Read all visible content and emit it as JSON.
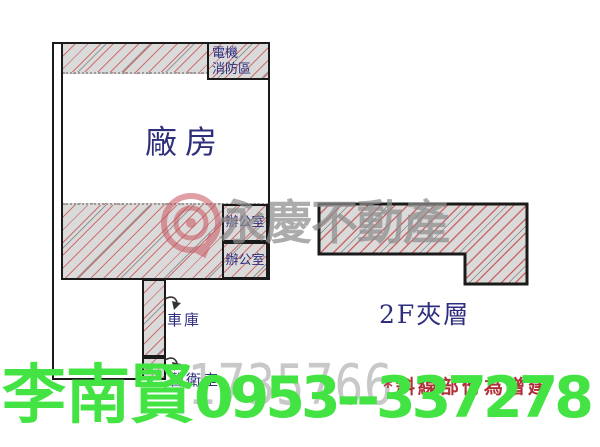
{
  "canvas": {
    "width": 600,
    "height": 447,
    "background": "#ffffff"
  },
  "colors": {
    "outline": "#1a1a1a",
    "label_navy": "#2e2e7d",
    "hatch_fill": "#dadada",
    "hatch_red_line": "#c85555",
    "hatch_dark_line": "#5f5f5f",
    "watermark_gray": "#8d8d8d",
    "watermark_number_gray": "#c8c8c8",
    "watermark_logo_pink": "#c9545e",
    "note_red": "#b0303a",
    "contact_green": "#44e344"
  },
  "plan": {
    "factory_label": "廠房",
    "electrical_area_line1": "電機",
    "electrical_area_line2": "消防區",
    "office_upper_label": "辦公室",
    "office_lower_label": "辦公室",
    "garage_label": "車庫",
    "guard_room_label": "警衛室",
    "mezzanine_label": "2F夾層"
  },
  "watermark": {
    "brand": "永慶不動產",
    "listing_number": "1735766"
  },
  "footer": {
    "agent_name": "李南賢",
    "agent_phone": "0953--337278",
    "note": "*斜線部份為增建"
  }
}
